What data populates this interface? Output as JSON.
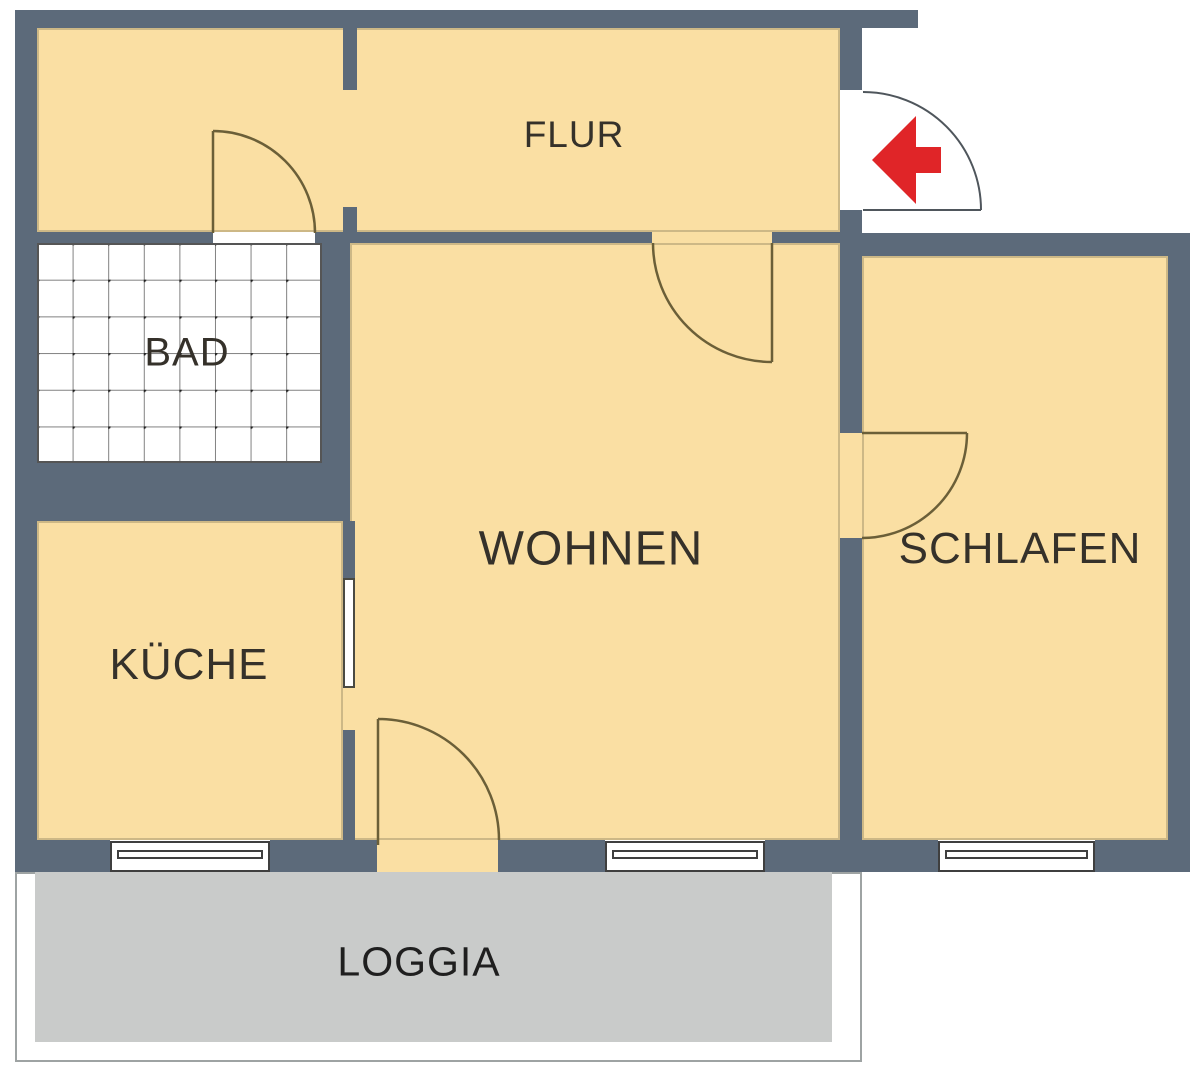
{
  "floorplan": {
    "rooms": [
      {
        "name": "flur",
        "label": "FLUR"
      },
      {
        "name": "bad",
        "label": "BAD"
      },
      {
        "name": "kueche",
        "label": "KÜCHE"
      },
      {
        "name": "wohnen",
        "label": "WOHNEN"
      },
      {
        "name": "schlafen",
        "label": "SCHLAFEN"
      },
      {
        "name": "loggia",
        "label": "LOGGIA"
      }
    ],
    "features": {
      "entrance_arrow_icon": "red-entrance-arrow",
      "doors": [
        "entrance-door",
        "bad-door",
        "wohnen-door",
        "schlafen-door",
        "loggia-door"
      ],
      "windows": [
        "kueche-window",
        "wohnen-window",
        "schlafen-window"
      ],
      "bad_floor": "tiled-grid-with-dots"
    },
    "colors": {
      "wall": "#5C6A7A",
      "room_fill": "#FADFA3",
      "loggia_fill": "#C9CBCA",
      "loggia_border": "#9EA3A3",
      "door_line": "#6B5F38",
      "entry_door_line": "#4F565C",
      "arrow_red": "#E02528",
      "label_text": "#35312A",
      "loggia_text": "#1F1F1F",
      "tile_line": "#808080",
      "tile_dot": "#1F1F1F",
      "window_line": "#3F3F3F",
      "background": "#FFFFFF"
    }
  }
}
